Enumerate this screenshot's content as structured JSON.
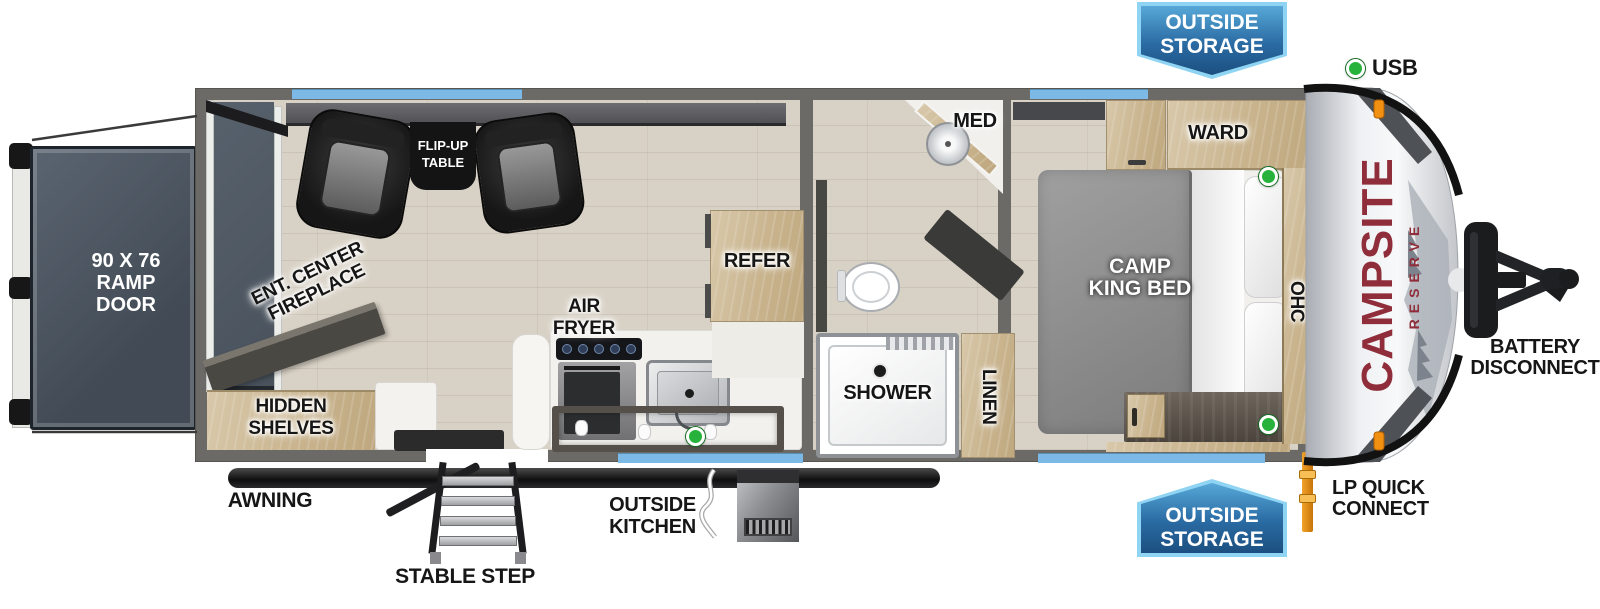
{
  "brand": {
    "name": "CAMPSITE",
    "series": "RESERVE"
  },
  "badges": {
    "top_outside_storage": {
      "line1": "OUTSIDE",
      "line2": "STORAGE"
    },
    "bottom_outside_storage": {
      "line1": "OUTSIDE",
      "line2": "STORAGE"
    }
  },
  "legend": {
    "usb_label": "USB"
  },
  "exterior": {
    "ramp_door": {
      "line1": "90 X 76",
      "line2": "RAMP",
      "line3": "DOOR"
    },
    "awning": "AWNING",
    "stable_step": "STABLE STEP",
    "outside_kitchen": {
      "line1": "OUTSIDE",
      "line2": "KITCHEN"
    },
    "lp_quick_connect": {
      "line1": "LP QUICK",
      "line2": "CONNECT"
    },
    "battery_disconnect": {
      "line1": "BATTERY",
      "line2": "DISCONNECT"
    }
  },
  "interior": {
    "flip_up_table": {
      "line1": "FLIP-UP",
      "line2": "TABLE"
    },
    "ent_center_fireplace": {
      "line1": "ENT. CENTER",
      "line2": "FIREPLACE"
    },
    "hidden_shelves": {
      "line1": "HIDDEN",
      "line2": "SHELVES"
    },
    "air_fryer": {
      "line1": "AIR",
      "line2": "FRYER"
    },
    "refer": "REFER",
    "med": "MED",
    "shower": "SHOWER",
    "linen": "LINEN",
    "ward": "WARD",
    "ohc": "OHC",
    "camp_king_bed": {
      "line1": "CAMP",
      "line2": "KING BED"
    }
  },
  "colors": {
    "badge_blue": "#2a6ba3",
    "badge_border": "#8fd4f2",
    "window_blue": "#7cb9e6",
    "usb_green": "#27b33b",
    "brand_red": "#8f2e3a",
    "lp_orange": "#e8920e",
    "wall_gray": "#6c6a67",
    "floor_tan": "#d8d1c5",
    "wood_tan": "#cdbb9c"
  }
}
